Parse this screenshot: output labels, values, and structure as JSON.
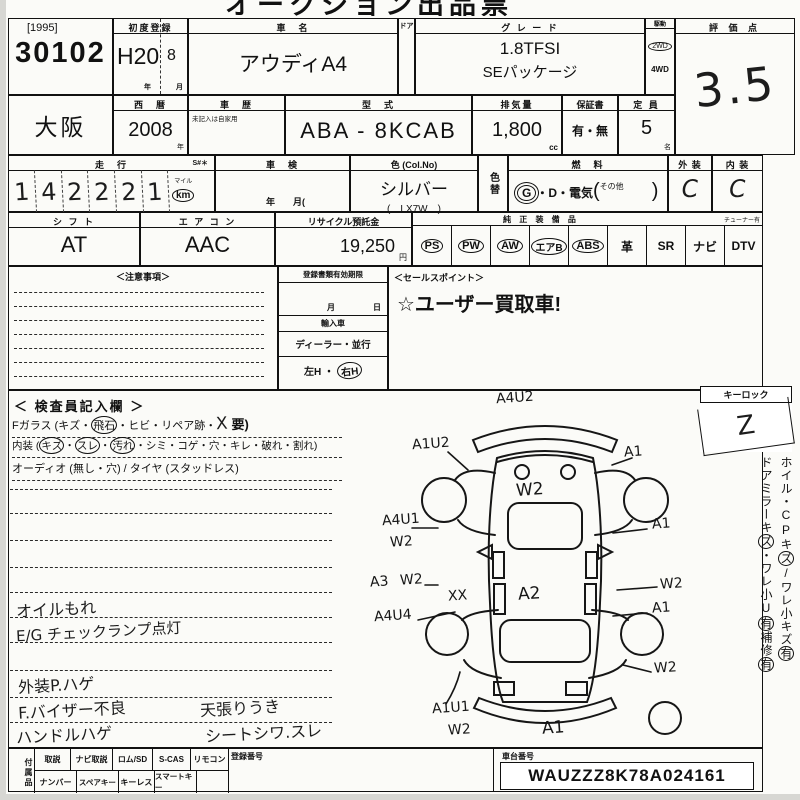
{
  "top_title": "オークション出品票",
  "lot": {
    "year": "[1995]",
    "number": "30102"
  },
  "first_registration": {
    "label": "初度登録",
    "era_year": "H20",
    "month": "8",
    "year_unit": "年",
    "month_unit": "月"
  },
  "car_name": {
    "label": "車　名",
    "value": "アウディA4"
  },
  "door_label": "ドア",
  "grade": {
    "label": "グ レ ー ド",
    "line1": "1.8TFSI",
    "line2": "SEパッケージ"
  },
  "drive": {
    "label": "駆動",
    "option_2wd": "2WD",
    "option_4wd": "4WD",
    "selected": "2WD"
  },
  "score": {
    "label": "評 価 点",
    "value": "3.5"
  },
  "location": {
    "value": "大阪"
  },
  "year_west": {
    "label": "西　暦",
    "value": "2008",
    "unit": "年"
  },
  "history": {
    "label": "車　歴",
    "note": "未記入は自家用"
  },
  "model_code": {
    "label": "型　式",
    "value": "ABA - 8KCAB"
  },
  "displacement": {
    "label": "排気量",
    "value": "1,800",
    "unit": "cc"
  },
  "warranty": {
    "label": "保証書",
    "value": "有・無"
  },
  "capacity": {
    "label": "定 員",
    "value": "5",
    "unit": "名"
  },
  "mileage": {
    "label": "走　行",
    "s_mark": "S#＊",
    "digits": [
      "1",
      "4",
      "2",
      "2",
      "2",
      "1"
    ],
    "unit_small": "マイル",
    "unit": "km"
  },
  "shaken": {
    "label": "車　検",
    "units": "年　　月("
  },
  "color": {
    "label": "色 (Col.No)",
    "value": "シルバー",
    "code": "(　LX7W　)"
  },
  "color_change_label": "色替",
  "fuel": {
    "label": "燃　料",
    "gas": "G",
    "middle": "・D・電気",
    "paren_open": "(",
    "other": "その他",
    "paren_close": ")"
  },
  "exterior": {
    "label": "外 装",
    "value": "C"
  },
  "interior": {
    "label": "内 装",
    "value": "C"
  },
  "shift": {
    "label": "シ フ ト",
    "value": "AT"
  },
  "aircon": {
    "label": "エ ア コ ン",
    "value": "AAC"
  },
  "recycle": {
    "label": "リサイクル預託金",
    "value": "19,250",
    "unit": "円"
  },
  "equipment": {
    "label": "純 正 装 備 品",
    "tuner_note": "チューナー有",
    "items": [
      {
        "label": "PS",
        "circled": true
      },
      {
        "label": "PW",
        "circled": true
      },
      {
        "label": "AW",
        "circled": true
      },
      {
        "label": "エアB",
        "circled": true
      },
      {
        "label": "ABS",
        "circled": true
      },
      {
        "label": "革",
        "circled": false
      },
      {
        "label": "SR",
        "circled": false
      },
      {
        "label": "ナビ",
        "circled": false
      },
      {
        "label": "DTV",
        "circled": false
      }
    ]
  },
  "caution": {
    "label": "＜注意事項＞"
  },
  "registration": {
    "expiry_label": "登録書類有効期限",
    "month_unit": "月",
    "day_unit": "日",
    "import_label": "輸入車",
    "import_options": "ディーラー・並行",
    "handle_left": "左H",
    "separator": "・",
    "handle_right": "右H"
  },
  "sales_point": {
    "label": "＜セールスポイント＞",
    "value": "☆ユーザー買取車!"
  },
  "inspector": {
    "title": "＜ 検査員記入欄 ＞",
    "glass": {
      "p1": "Fガラス (キズ・",
      "c1": "飛石",
      "p2": "・ヒビ・リペア跡・",
      "hand": "X",
      "p3": " 要)"
    },
    "interior_note": {
      "p1": "内装 (",
      "c1": "キズ",
      "d1": "・",
      "c2": "スレ",
      "d2": "・",
      "c3": "汚れ",
      "p2": "・シミ・コゲ・穴・キレ・破れ・割れ)"
    },
    "audio_note": "オーディオ (無し・穴) / タイヤ (スタッドレス)",
    "hand_notes": [
      {
        "left": "オイルもれ",
        "right": ""
      },
      {
        "left": "E/G チェックランプ点灯",
        "right": ""
      },
      {
        "left": "外装P.ハゲ",
        "right": ""
      },
      {
        "left": "F.バイザー不良",
        "right": "天張りうき"
      },
      {
        "left": "ハンドルハゲ",
        "right": "シートシワ.スレ"
      }
    ]
  },
  "keylock": {
    "label": "キーロック",
    "mark": "Z"
  },
  "side_notes": [
    {
      "t": "ホイル・CPキ",
      "circled": false
    },
    {
      "t": "ズ",
      "circled": true
    },
    {
      "t": "/ワレ",
      "circled": false
    },
    {
      "t": "小キズ",
      "circled": false
    },
    {
      "t": "有",
      "circled": true
    },
    {
      "t": "ドアミラーキ",
      "circled": false
    },
    {
      "t": "ズ",
      "circled": true
    },
    {
      "t": "・ワレ",
      "circled": false
    },
    {
      "t": "小U",
      "circled": false
    },
    {
      "t": "有",
      "circled": true
    },
    {
      "t": "補修",
      "circled": false
    },
    {
      "t": "有",
      "circled": true
    }
  ],
  "diagram": {
    "marks": [
      {
        "t": "A4U2",
        "x": 126,
        "y": 2
      },
      {
        "t": "A1U2",
        "x": 42,
        "y": 48
      },
      {
        "t": "A1",
        "x": 254,
        "y": 56
      },
      {
        "t": "W2",
        "x": 146,
        "y": 92,
        "big": true
      },
      {
        "t": "A4U1",
        "x": 12,
        "y": 124
      },
      {
        "t": "W2",
        "x": 20,
        "y": 146
      },
      {
        "t": "A1",
        "x": 282,
        "y": 128
      },
      {
        "t": "A3",
        "x": 0,
        "y": 186
      },
      {
        "t": "W2",
        "x": 30,
        "y": 184
      },
      {
        "t": "XX",
        "x": 78,
        "y": 200
      },
      {
        "t": "A2",
        "x": 148,
        "y": 196,
        "big": true
      },
      {
        "t": "W2",
        "x": 290,
        "y": 188
      },
      {
        "t": "A4U4",
        "x": 4,
        "y": 220
      },
      {
        "t": "A1",
        "x": 282,
        "y": 212
      },
      {
        "t": "W2",
        "x": 284,
        "y": 272
      },
      {
        "t": "A1U1",
        "x": 62,
        "y": 312
      },
      {
        "t": "W2",
        "x": 78,
        "y": 334
      },
      {
        "t": "A1",
        "x": 172,
        "y": 330,
        "big": true
      }
    ]
  },
  "accessories": {
    "label": "付属品",
    "row1": [
      "取説",
      "ナビ取説",
      "ロム/SD",
      "S-CAS",
      "リモコン"
    ],
    "row2": [
      "ナンバー",
      "スペアキー",
      "キーレス",
      "スマートキー"
    ],
    "registration_no_label": "登録番号"
  },
  "chassis": {
    "label": "車台番号",
    "value": "WAUZZZ8K78A024161"
  }
}
